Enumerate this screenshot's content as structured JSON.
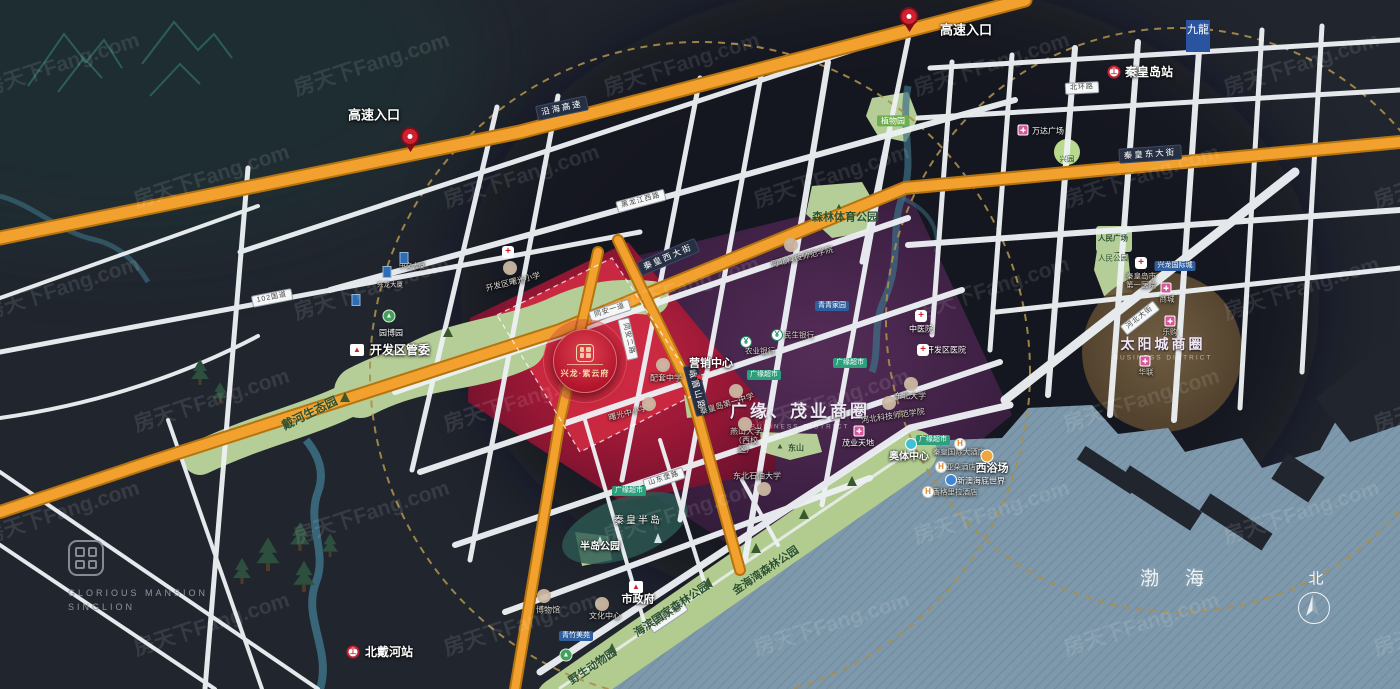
{
  "watermark": {
    "text": "房天下Fang.com"
  },
  "icons": {
    "cross": "+",
    "hotel": "H",
    "bank": "¥",
    "train": "工",
    "gov": "▲",
    "tree": "▲",
    "star": "★"
  },
  "compass": {
    "north": "北"
  },
  "sea": {
    "name": "渤海"
  },
  "logo": {
    "line1": "GLORIOUS MANSION",
    "line2": "SINGLION"
  },
  "badge": {
    "text": "九龍"
  },
  "property": {
    "name": "兴龙·紫云府"
  },
  "entrances": {
    "e1": "高速入口",
    "e2": "高速入口"
  },
  "highways": {
    "yanhai": "沿海高速",
    "qinhuang_west": "秦皇西大街",
    "qinhuang_east": "秦皇东大街",
    "emeishan": "峨眉山路"
  },
  "roads": {
    "g102": "102国道",
    "heilongjiang_w": "黑龙江西路",
    "tongan1": "同安一道",
    "tongan2": "同安二路",
    "shandongbao": "山东堡路",
    "binhai": "滨海大道",
    "beihuan": "北环路",
    "hebei": "河北大街"
  },
  "stations": {
    "qinhuangdao": "秦皇岛站",
    "beidaihe": "北戴河站"
  },
  "districts": {
    "guangyuan": {
      "name": "广缘、茂业商圈",
      "sub": "BUSINESS DISTRICT"
    },
    "taiyangcheng": {
      "name": "太阳城商圈",
      "sub": "BUSINESS DISTRICT"
    }
  },
  "parks": {
    "daihe": "戴河生态园",
    "yuanbo": "园博园",
    "zhiwu": "植物园",
    "senlin": "森林体育公园",
    "dongshan": "东山",
    "bandao": "半岛公园",
    "qinhuang_bandao": "秦皇半岛",
    "haibin": "海滨国家森林公园",
    "jinhaiwan": "金海湾森林公园",
    "yesheng": "野生动物园",
    "renmin_sq": "人民广场",
    "renmin_park": "人民公园",
    "xingyuan": "兴园"
  },
  "education": {
    "kfq_primary": "开发区曙光小学",
    "shuguang": "曙光中小学",
    "peitao": "配套中学",
    "no1_middle": "秦皇岛第一中学",
    "yanshan": "燕山大学（西校区）",
    "dongbei": "东北大学",
    "shiyou": "东北石油大学",
    "hbkj": "河北科技师范学院"
  },
  "culture": {
    "wenhua": "文化中心",
    "bowuguan": "博物馆"
  },
  "gov": {
    "kfq": "开发区管委",
    "shizhengfu": "市政府",
    "marketing": "营销中心"
  },
  "hospitals": {
    "zhongyi": "中医院",
    "kfq": "开发区医院",
    "no1": "秦皇岛市第一医院"
  },
  "banks": {
    "nongye": "农业银行",
    "minsheng": "民生银行"
  },
  "commerce": {
    "wanda": "万达广场",
    "maoye": "茂业天地",
    "shangcheng": "商城",
    "legou": "乐购",
    "hualian": "华联",
    "guangyuan_super": "广缘超市"
  },
  "leisure": {
    "aoti": "奥体中心",
    "xiyuchang": "西浴场",
    "xinao": "新澳海底世界"
  },
  "hotels": {
    "qinhuang": "秦皇国际大酒店",
    "yaduo": "亚朵酒店",
    "shangrila": "香格里拉酒店"
  },
  "residential": {
    "qingqing": "青青家园",
    "qingzhu": "青竹美苑",
    "xinglong_intl": "兴龙国际城"
  },
  "towers": {
    "xinglong": "兴龙大厦",
    "zhongjiao": "中交大厦"
  }
}
